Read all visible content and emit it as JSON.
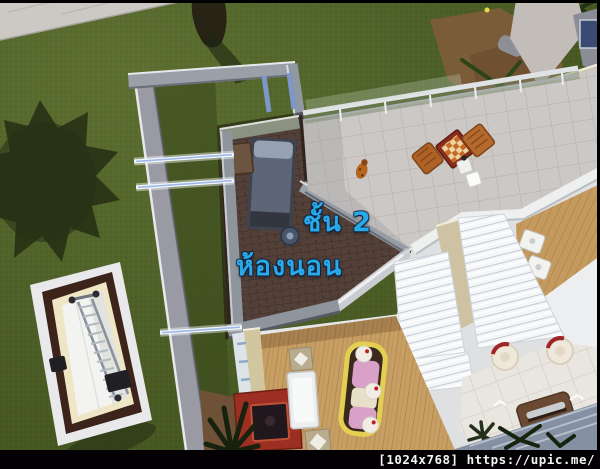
{
  "window": {
    "width": 600,
    "height": 469
  },
  "scene": {
    "description": "life-simulation game top-down cutaway view of house second floor",
    "annotations": {
      "floor_label": "ชั้น 2",
      "room_label": "ห้องนอน",
      "label_color": "#29A9E8"
    },
    "watermark": {
      "text": "[1024x768] https://upic.me/",
      "bar_color": "#030103",
      "text_color": "#F5F3F5"
    },
    "palette": {
      "grass": "#4E6128",
      "grass_shadow": "#222B12",
      "sidewalk": "#CCC8C3",
      "wall_gray": "#9298A0",
      "wall_highlight": "#E8E8EA",
      "bedroom_floor": "#4E3B31",
      "terrace_tile": "#CBC8C5",
      "deck_wood": "#C79E63",
      "louver_white": "#F4F6F8",
      "patio_tile": "#E9E6E0",
      "roof_blue": "#8590A2",
      "chess_table_red": "#8A2B1B",
      "chair_wood": "#B06226",
      "sofa_yellow": "#E3CF52",
      "sofa_pink": "#D9A0C8",
      "arcade_red": "#9C2F22",
      "window_glass": "#9DB8E8"
    },
    "objects": [
      "bed",
      "dresser",
      "chamber-pot",
      "chess-table",
      "dining-chair",
      "storage-cube",
      "pet-creature",
      "ladder",
      "sofa",
      "arcade-cabinet",
      "bar-counter",
      "floor-speaker",
      "lounge-chair",
      "garden-bench",
      "potted-plant",
      "glass-railing",
      "louvered-roof",
      "palm-shadow",
      "tree-shadow"
    ]
  }
}
